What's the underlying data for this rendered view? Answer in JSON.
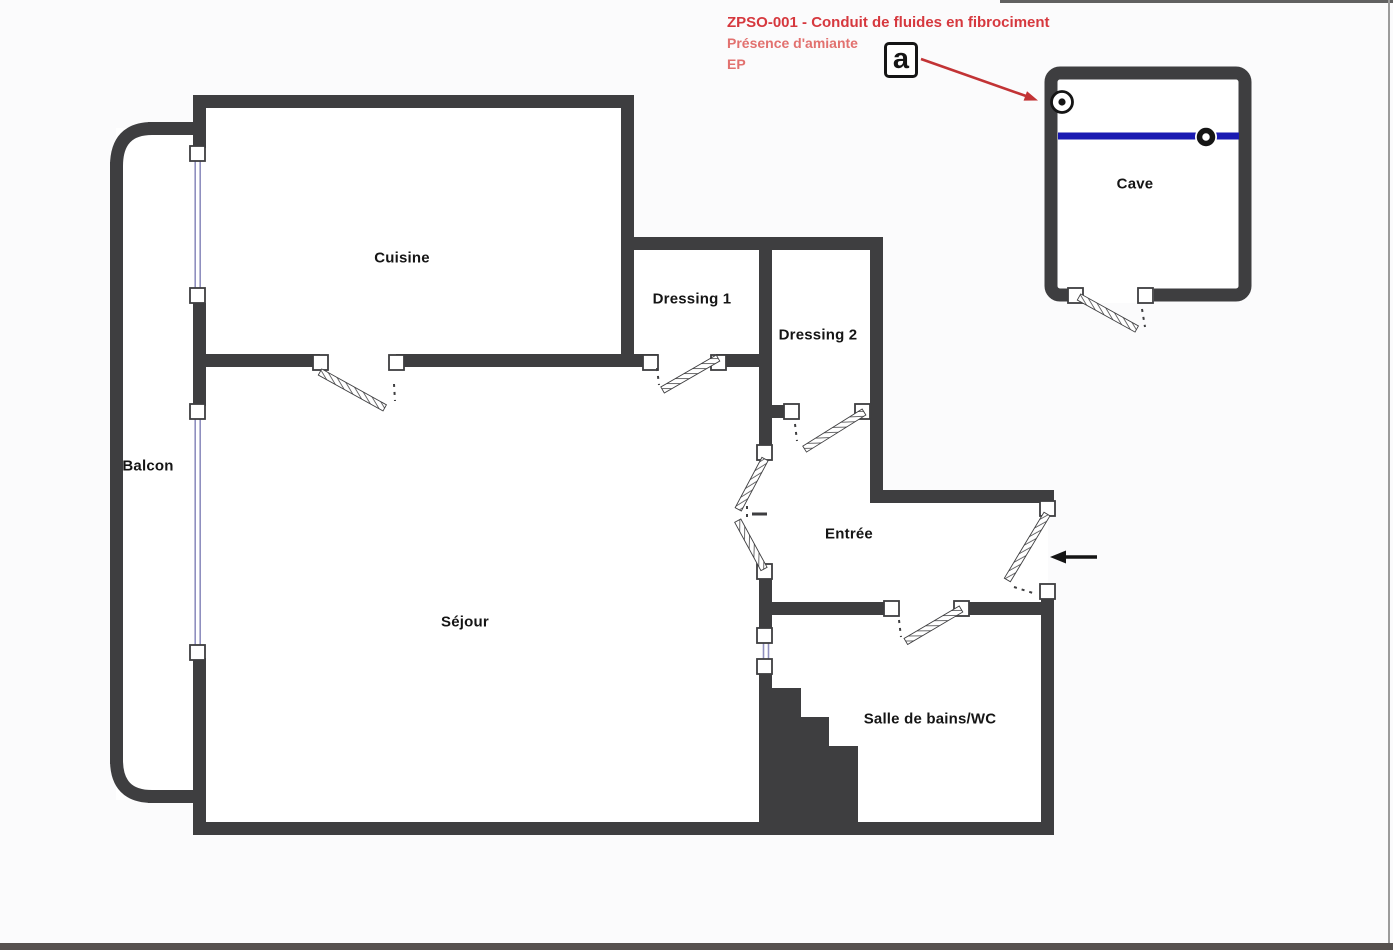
{
  "annotation": {
    "line1": "ZPSO-001 - Conduit de fluides en fibrociment",
    "line2": "Présence d'amiante",
    "line3": "EP",
    "symbol": "a"
  },
  "rooms": {
    "cuisine": "Cuisine",
    "dressing1": "Dressing 1",
    "dressing2": "Dressing 2",
    "balcon": "Balcon",
    "sejour": "Séjour",
    "entree": "Entrée",
    "salle_de_bains": "Salle de bains/WC",
    "cave": "Cave"
  },
  "icons": {
    "asbestos_box": "a-in-square",
    "asbestos_source": "circled-dot",
    "conduit_marker": "black-ring",
    "entry_arrow": "left-black-arrow",
    "annotation_arrow": "red-arrow-down-right"
  },
  "colors": {
    "wall": "#3e3e40",
    "conduit_blue": "#1a1ab2",
    "annotation_red_bold": "#d6383e",
    "annotation_red_light": "#e2716f",
    "arrow_red": "#c23335",
    "window_frame": "#8f8fbf",
    "ink": "#151515",
    "background": "#fbfbfc"
  }
}
